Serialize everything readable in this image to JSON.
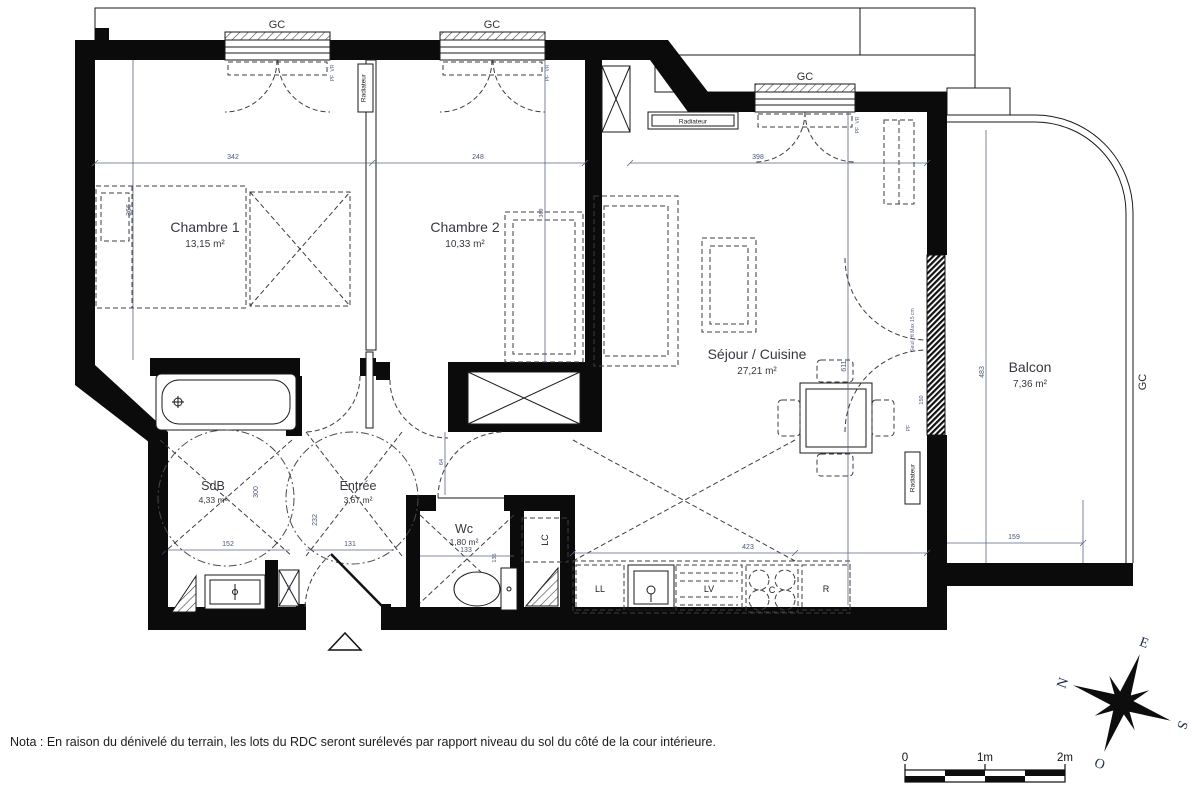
{
  "rooms": {
    "chambre1": {
      "name": "Chambre 1",
      "area": "13,15 m²"
    },
    "chambre2": {
      "name": "Chambre 2",
      "area": "10,33 m²"
    },
    "sejour": {
      "name": "Séjour / Cuisine",
      "area": "27,21 m²"
    },
    "balcon": {
      "name": "Balcon",
      "area": "7,36 m²"
    },
    "sdb": {
      "name": "SdB",
      "area": "4,33 m²"
    },
    "entree": {
      "name": "Entrée",
      "area": "3,67 m²"
    },
    "wc": {
      "name": "Wc",
      "area": "1,80 m²"
    }
  },
  "equipment": {
    "gc": "GC",
    "radiateur": "Radiateur",
    "lc": "LC",
    "ll": "LL",
    "lv": "LV",
    "cooktop": "C",
    "fridge": "R",
    "ta": "TA",
    "pf": "PF",
    "vr": "VR",
    "seuil": "Seuil Ht Max 15 cm"
  },
  "dimensions": {
    "top_left": "342",
    "top_mid": "248",
    "top_right": "398",
    "ch1_height": "366",
    "ch2_height": "369",
    "sejour_height": "611",
    "kitchen_width": "423",
    "passage": "64",
    "sdb_width": "152",
    "sdb_height": "300",
    "entree_width": "131",
    "entree_height": "232",
    "wc_width": "133",
    "wc_height": "135",
    "balcon_height": "483",
    "balcon_width": "159",
    "pf_width": "150"
  },
  "compass": {
    "n": "N",
    "e": "E",
    "s": "S",
    "o": "O"
  },
  "scale_bar": {
    "zero": "0",
    "one": "1m",
    "two": "2m"
  },
  "note": "Nota : En raison du dénivelé du terrain, les lots du RDC seront surélevés par rapport niveau du sol du côté de la cour intérieure."
}
